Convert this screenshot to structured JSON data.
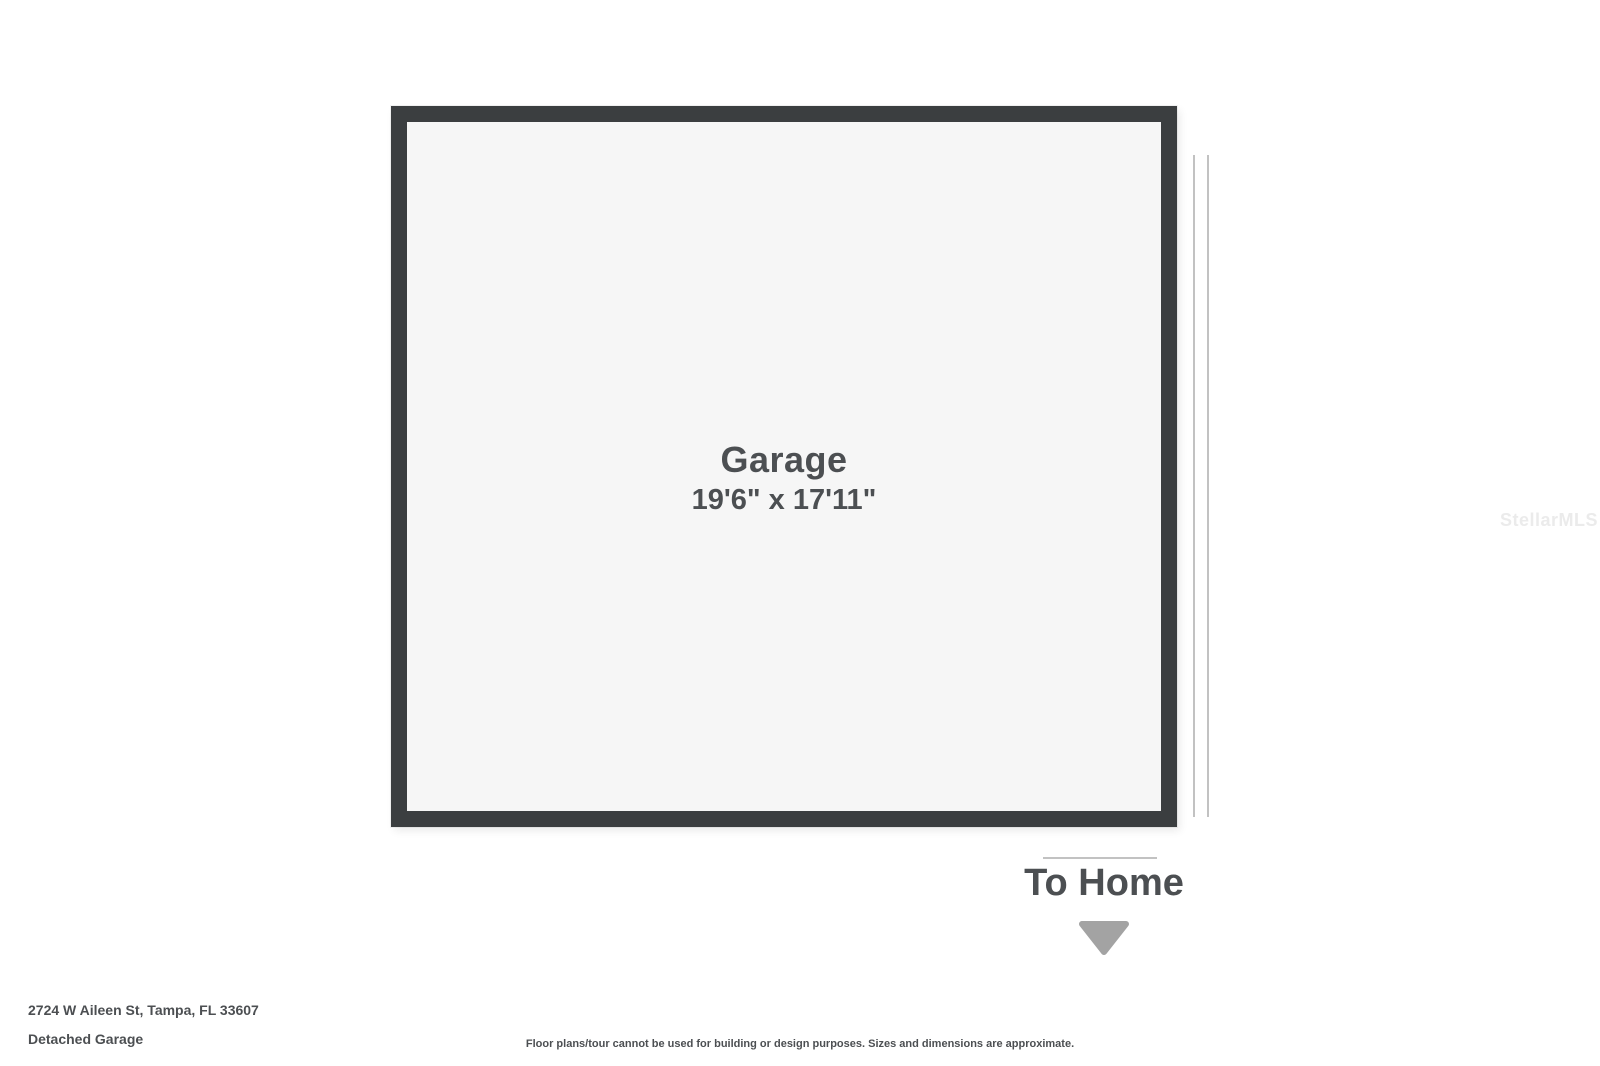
{
  "watermark": "StellarMLS",
  "colors": {
    "wall": "#3b3e40",
    "room-fill": "#f6f6f6",
    "text": "#4c4f52",
    "arrow": "#a3a3a3",
    "opening-line": "#c2c2c2",
    "watermark": "#ebebeb"
  },
  "floorplan": {
    "room": {
      "name": "Garage",
      "dimensions": "19'6\" x 17'11\""
    },
    "door_label": "To Home"
  },
  "footer": {
    "address": "2724 W Aileen St, Tampa, FL 33607",
    "plan_title": "Detached Garage",
    "disclaimer": "Floor plans/tour cannot be used for building or design purposes. Sizes and dimensions are approximate."
  }
}
